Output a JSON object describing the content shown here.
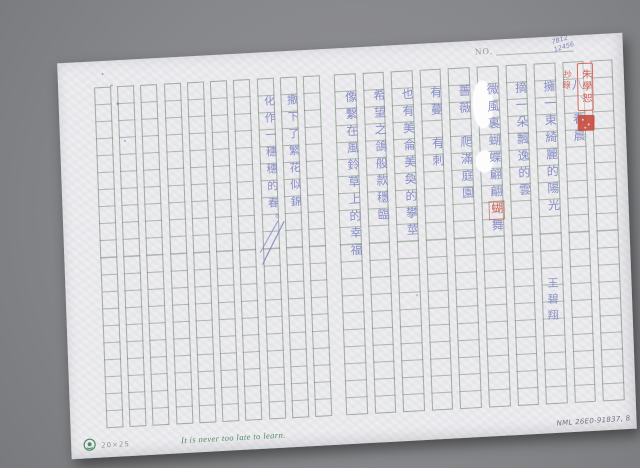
{
  "header": {
    "no_label": "NO."
  },
  "manuscript": {
    "right_page_columns": [
      {
        "text": "八、春晨"
      },
      {
        "text": "擁一束綺麗的陽光"
      },
      {
        "text": "摘一朵飄逸的雲"
      },
      {
        "text_main": "微風裏蝴蝶翩翩",
        "text_red": "蝴",
        "text_tail": "舞"
      },
      {
        "text": "薔薇　爬滿庭園"
      },
      {
        "text": "有蔓　有刺"
      },
      {
        "text": "也有美侖美奐的攀莖"
      },
      {
        "text": "希望之鴿般款穩臨"
      },
      {
        "text": "像繫在風鈴草上的幸福"
      }
    ],
    "left_page_columns": [
      {
        "text": "撒下了繁花似錦"
      },
      {
        "text": "化作一穗穗的春。"
      }
    ],
    "signature": "王碧翔"
  },
  "annotations": {
    "stamp_text": "朱學恕",
    "red_note": "抄錄",
    "blue_code_line1": "7812",
    "blue_code_line2": "12456",
    "catalog_code": "NML 26E0-91837, 8"
  },
  "footer": {
    "grid_spec": "20×25",
    "motto": "It is never too late to learn."
  },
  "icons": {
    "logo": "publisher-emblem-icon",
    "seal": "red-seal-icon"
  },
  "colors": {
    "bg": "#898a8d",
    "paper": "#eae9ec",
    "ink": "#7b82c0",
    "red": "#c64c3c",
    "green": "#4e8a63",
    "printgreen": "#8a9a8a"
  }
}
